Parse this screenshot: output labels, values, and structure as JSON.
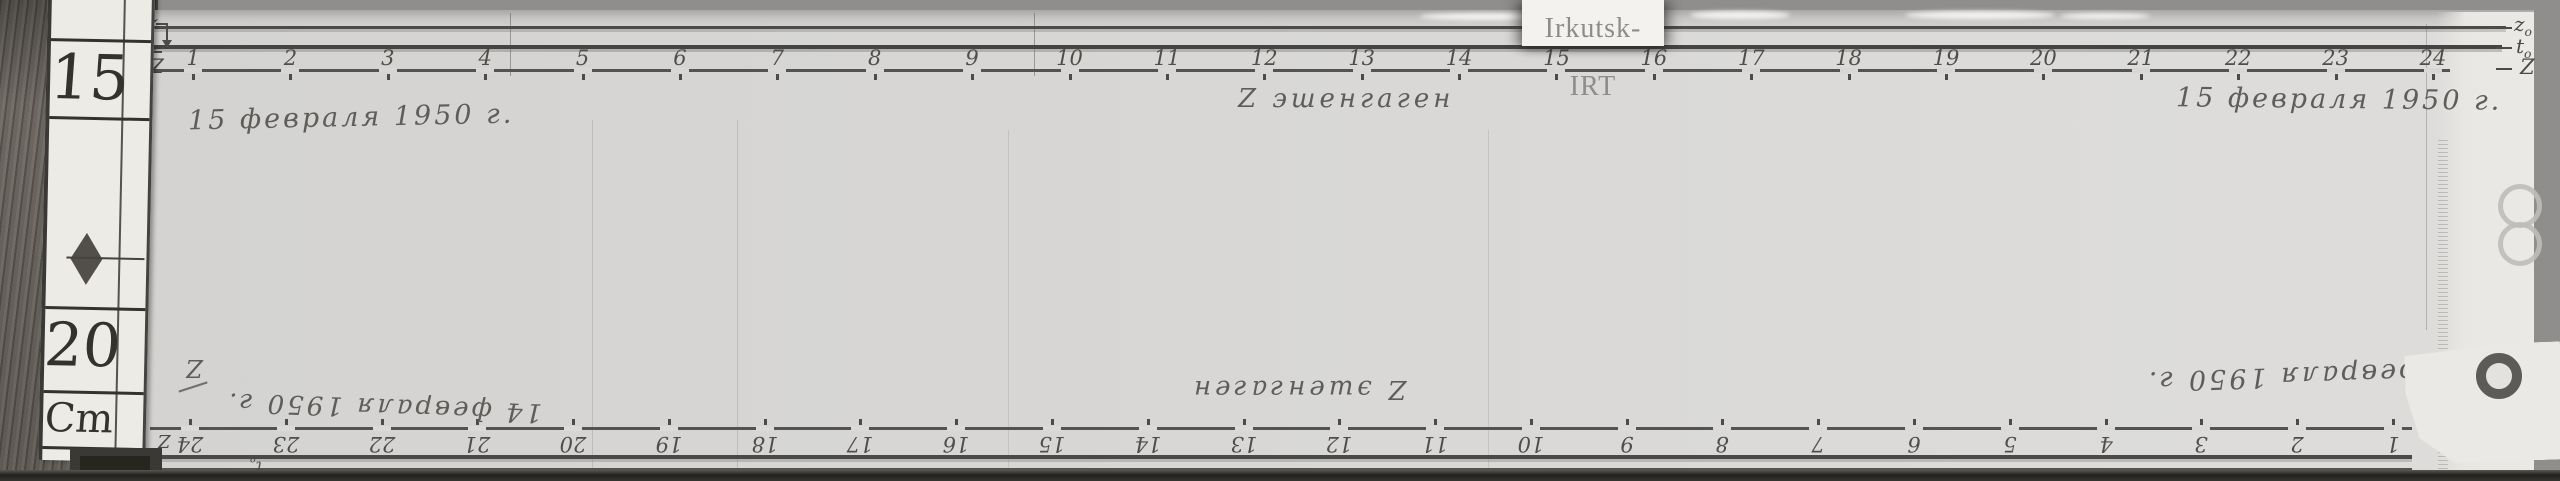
{
  "station": {
    "tag_label": "Irkutsk-IRT"
  },
  "ruler": {
    "value_top": "15",
    "value_bottom": "20",
    "unit": "Cm"
  },
  "top_record": {
    "date_left": "15 февраля 1950 г.",
    "caption_center": "Z эшенгаген",
    "date_right": "15 февраля 1950 г.",
    "hours": [
      "1",
      "2",
      "3",
      "4",
      "5",
      "6",
      "7",
      "8",
      "9",
      "10",
      "11",
      "12",
      "13",
      "14",
      "15",
      "16",
      "17",
      "18",
      "19",
      "20",
      "21",
      "22",
      "23",
      "24"
    ],
    "labels_left": {
      "z": "z",
      "t_main": "t",
      "t_sub": "o",
      "z_trace": "Z"
    },
    "labels_right": {
      "z0_main": "z",
      "z0_sub": "o",
      "t_main": "t",
      "t_sub": "o",
      "z_trace": "Z"
    }
  },
  "bottom_record": {
    "date_left": "14 февраля 1950 г.",
    "caption_center": "Z эшенгаген",
    "date_right": "14 февраля 1950 г.",
    "hours": [
      "24",
      "23",
      "22",
      "21",
      "20",
      "19",
      "18",
      "17",
      "16",
      "15",
      "14",
      "13",
      "12",
      "11",
      "10",
      "9",
      "8",
      "7",
      "6",
      "5",
      "4",
      "3",
      "2",
      "1"
    ],
    "label_start": "Z",
    "label_z_mark": "Z",
    "labels_edge": {
      "t_main": "t",
      "t_sub": "o",
      "z_main": "z",
      "z_sub": "o"
    }
  },
  "colors": {
    "paper": "#d9d8d6",
    "trace_ink": "#4c4b49",
    "handwriting": "#5e5d5a",
    "wood": "#6b6660",
    "background": "#8f8e8c",
    "tag_background": "#f3f2ee"
  }
}
